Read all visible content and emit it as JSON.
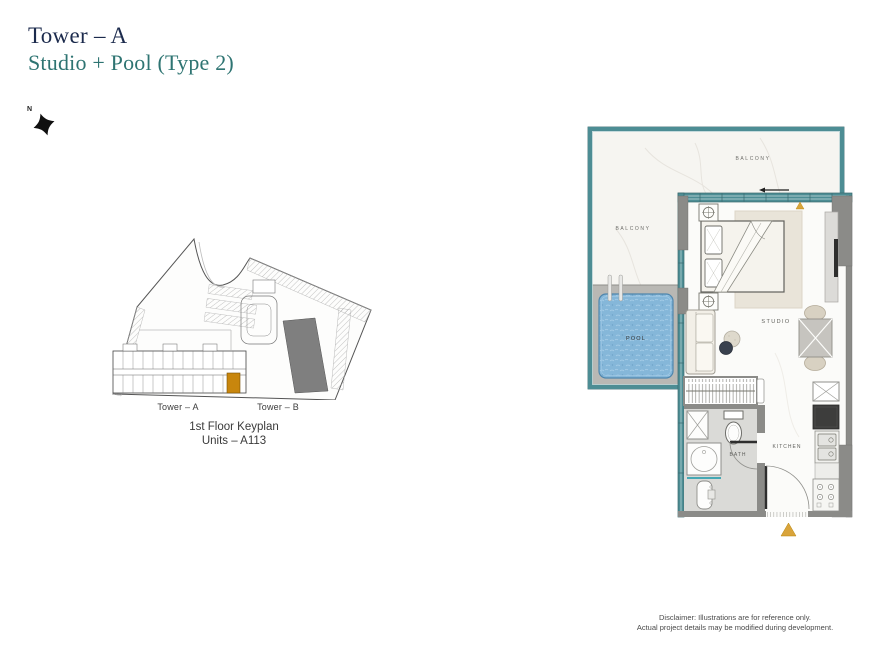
{
  "page": {
    "title": "Tower – A",
    "subtitle": "Studio + Pool (Type 2)"
  },
  "compass": {
    "north": "N"
  },
  "keyplan": {
    "tower_a": "Tower – A",
    "tower_b": "Tower – B",
    "caption1": "1st Floor Keyplan",
    "caption2": "Units – A113",
    "highlight_color": "#c8860d"
  },
  "floorplan": {
    "labels": {
      "balcony_top": "BALCONY",
      "balcony_left": "BALCONY",
      "pool": "POOL",
      "studio": "STUDIO",
      "bath": "BATH",
      "kitchen": "KITCHEN"
    },
    "colors": {
      "wall_teal": "#4d8d94",
      "wall_gray": "#8b8b88",
      "pool_water": "#85b7d9",
      "accent_amber": "#d9a43b"
    }
  },
  "disclaimer": {
    "line1": "Disclaimer: Illustrations are for reference only.",
    "line2": "Actual project details may be modified during development."
  }
}
